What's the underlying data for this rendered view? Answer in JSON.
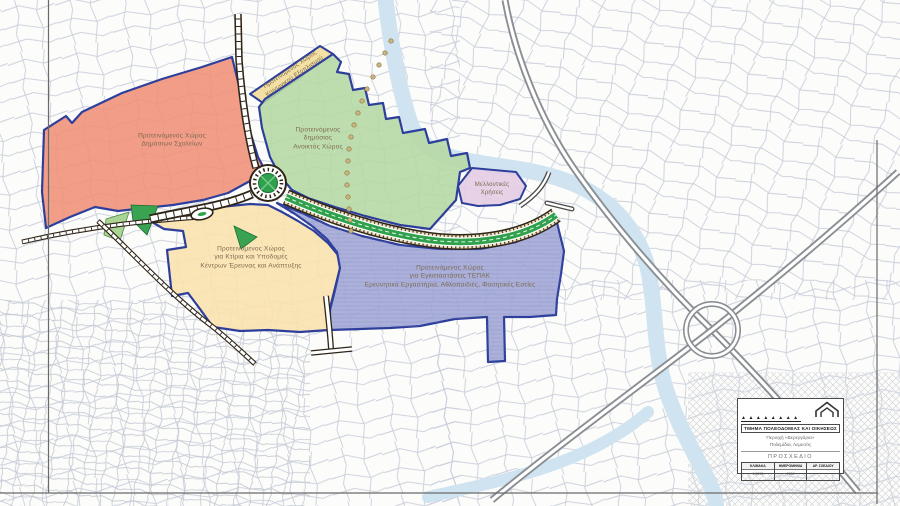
{
  "zones": [
    {
      "id": "schools",
      "label_lines": [
        "Προτεινόμενος Χώρος",
        "Δημόσιων Σχολείων"
      ],
      "color": "#ef8f77"
    },
    {
      "id": "social-equipment",
      "label_lines": [
        "Προτεινόμενος Χώρος",
        "Κοινωνικού Εξοπλισμού"
      ],
      "color": "#f2dd9b"
    },
    {
      "id": "public-open-space",
      "label_lines": [
        "Προτεινόμενος",
        "δημόσιος",
        "Ανοικτός Χώρος"
      ],
      "color": "#b5d8a3"
    },
    {
      "id": "future-uses",
      "label_lines": [
        "Μελλοντικές",
        "Χρήσεις"
      ],
      "color": "#e3cce4"
    },
    {
      "id": "research-development",
      "label_lines": [
        "Προτεινόμενος Χώρος",
        "για Κτίρια και Υποδομές",
        "Κέντρων Έρευνας και Ανάπτυξης"
      ],
      "color": "#f9e2ae"
    },
    {
      "id": "tepak",
      "label_lines": [
        "Προτεινόμενος Χώρος",
        "για Εγκαταστάσεις ΤΕΠΑΚ",
        "Ερευνητικά Εργαστήρια, Αθλοπαιδιές, Φοιτητικές Εστίες"
      ],
      "color": "#a0a6d6"
    }
  ],
  "title_block": {
    "logo_glyphs": "▲▲▲▲▲▲▲▲",
    "department": "ΤΜΗΜΑ ΠΟΛΕΟΔΟΜΙΑΣ ΚΑΙ ΟΙΚΗΣΕΩΣ",
    "area_line1": "Περιοχή «Βερεγγάρια»",
    "area_line2": "Πολεμίδια, Λεμεσός",
    "status": "ΠΡΟΣΧΕΔΙΟ",
    "fields": [
      {
        "label": "ΚΛΙΜΑΚΑ",
        "value": "1:5000"
      },
      {
        "label": "ΗΜΕΡΟΜΗΝΙΑ",
        "value": "2009"
      },
      {
        "label": "ΑΡ. ΣΧΕΔΙΟΥ",
        "value": ""
      }
    ]
  },
  "colors": {
    "boundary_blue": "#2e3f9b",
    "road_casing": "#2e2417",
    "gray_road": "#8b8f93",
    "river": "#cfe4f0",
    "median_green": "#2fa04c",
    "parcel_line": "#c9cedb",
    "label_text": "#7b6950"
  }
}
